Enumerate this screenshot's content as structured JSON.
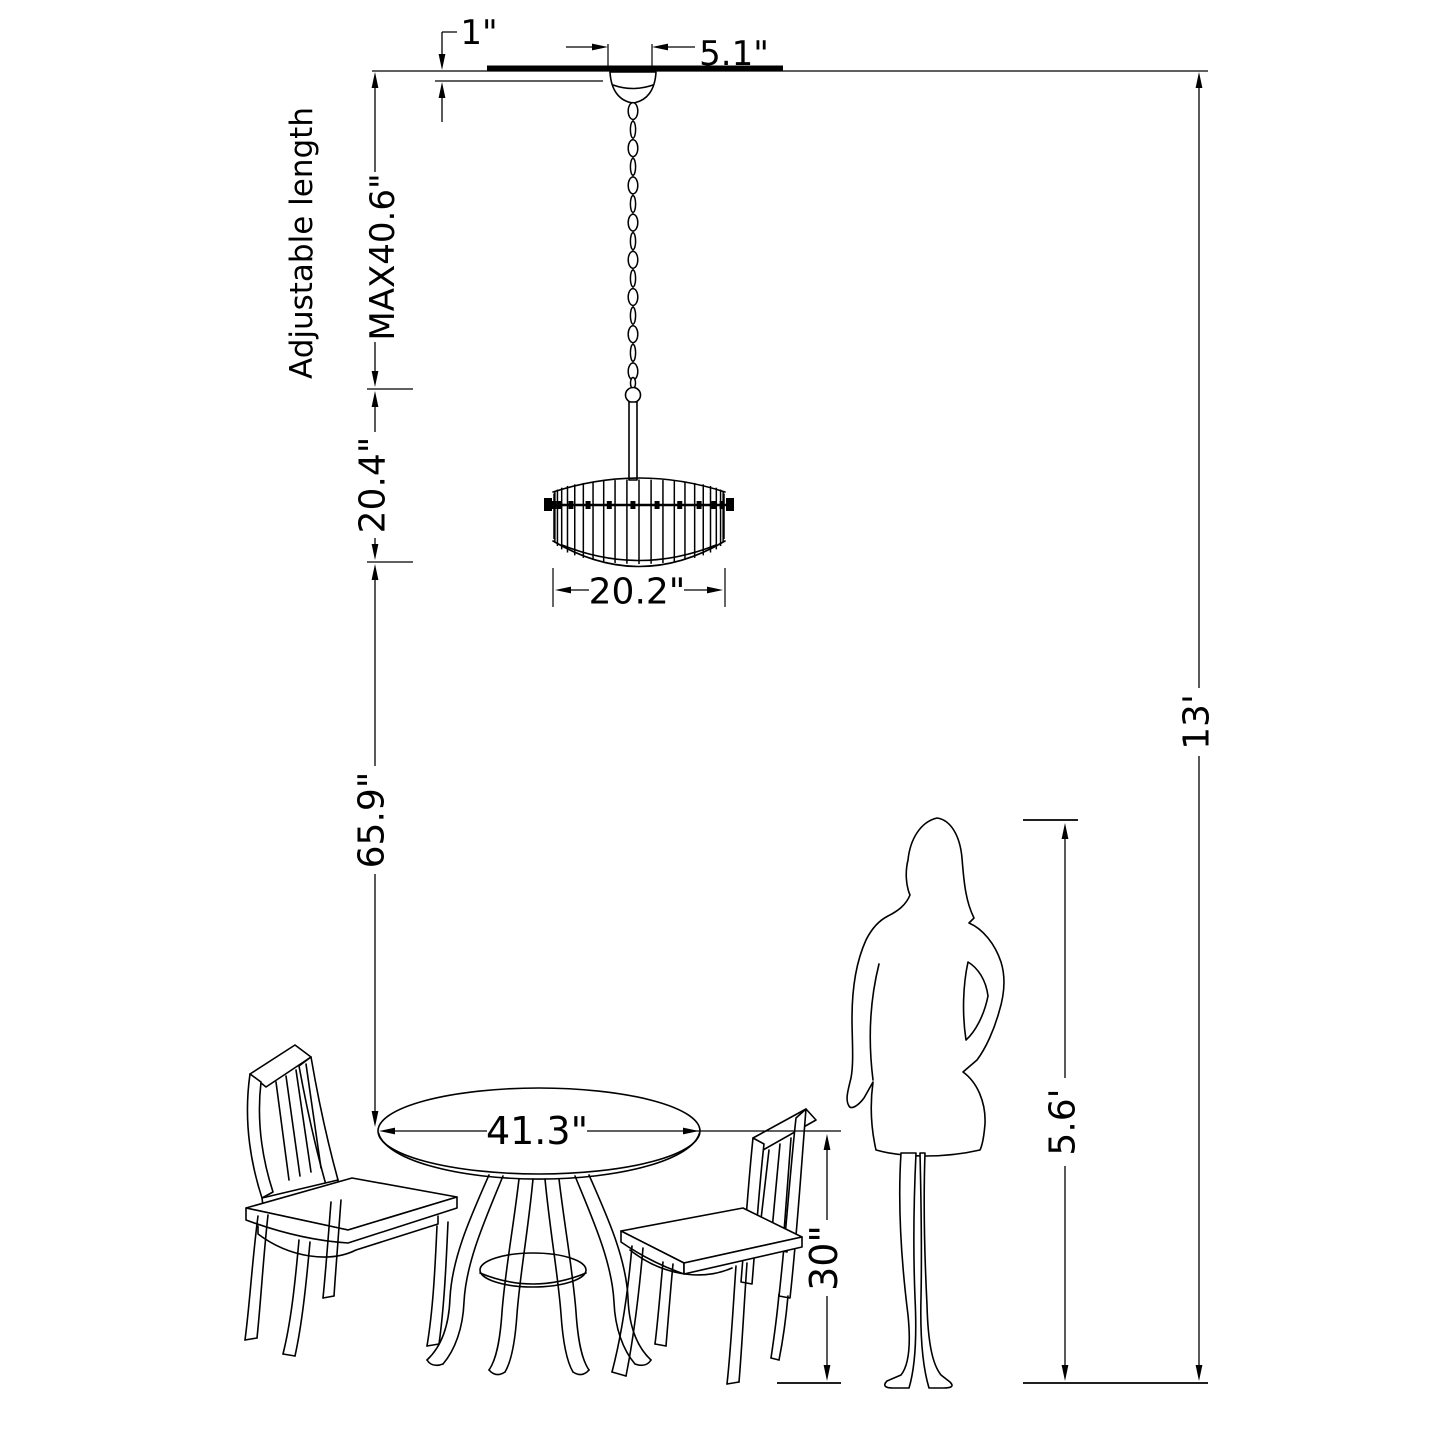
{
  "page": {
    "background": "#ffffff",
    "ink": "#000000"
  },
  "diagram": {
    "labels": {
      "canopy_inset": "1\"",
      "canopy_width": "5.1\"",
      "adjustable_length": "Adjustable length",
      "max_length": "MAX40.6\"",
      "fixture_height": "20.4\"",
      "fixture_diameter": "20.2\"",
      "hanging_clearance": "65.9\"",
      "ceiling_height": "13'",
      "table_diameter": "41.3\"",
      "table_height": "30\"",
      "person_height": "5.6'"
    }
  }
}
